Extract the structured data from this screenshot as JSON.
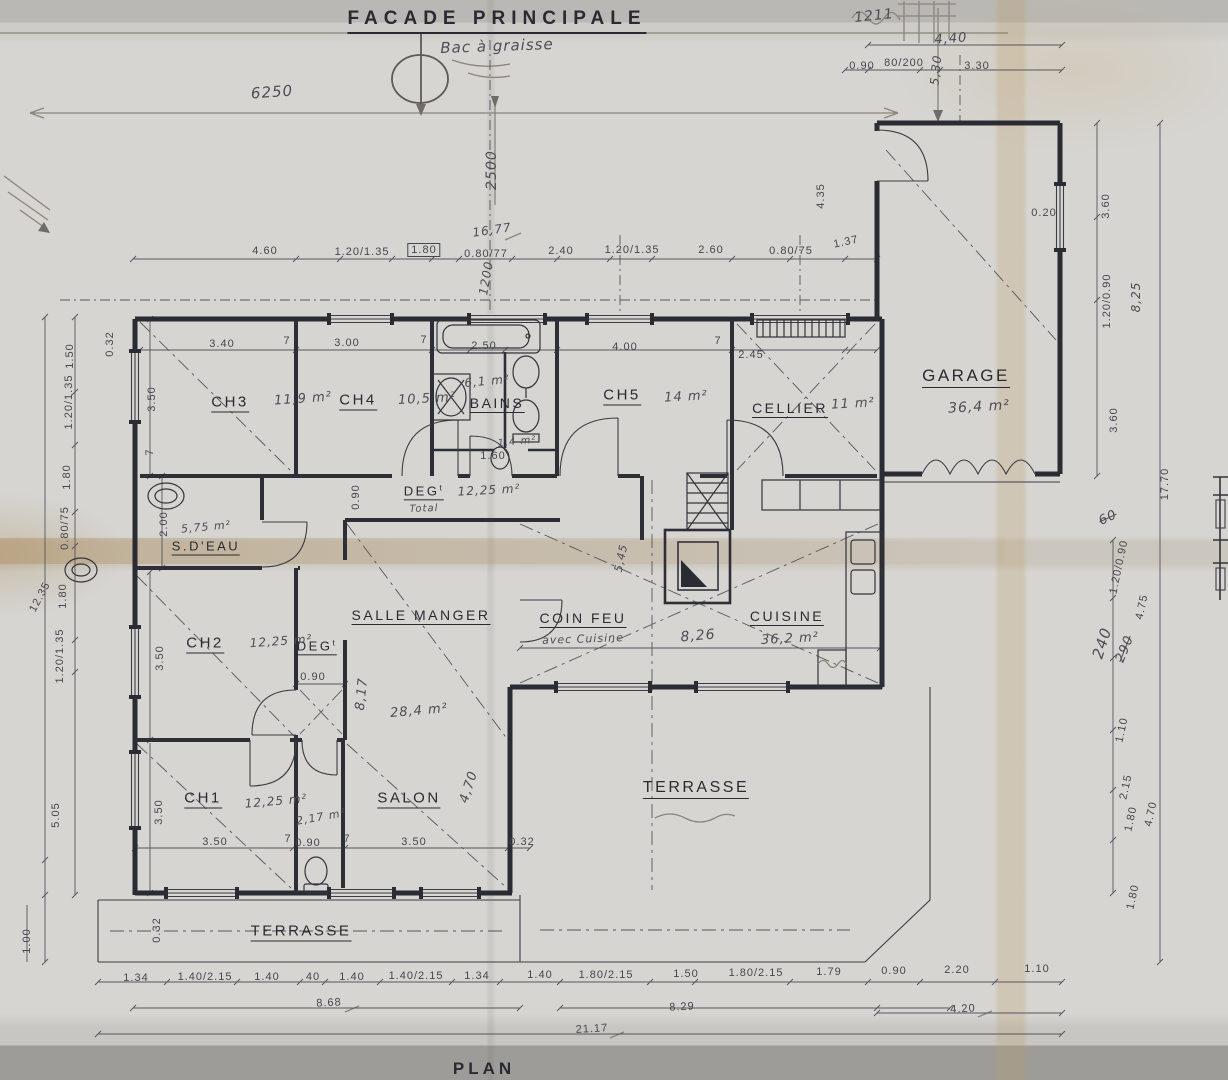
{
  "colors": {
    "ink": "#2a2a32",
    "dim": "#46464e"
  },
  "titles": {
    "main": "FACADE PRINCIPALE",
    "plan": "PLAN"
  },
  "plan": {
    "rooms": [
      {
        "text": "CH3",
        "x": 230,
        "y": 403,
        "u": true
      },
      {
        "text": "CH4",
        "x": 358,
        "y": 401,
        "u": true
      },
      {
        "text": "BAINS",
        "x": 497,
        "y": 404,
        "size": 14,
        "u": true
      },
      {
        "text": "CH5",
        "x": 622,
        "y": 396,
        "u": true
      },
      {
        "text": "CELLIER",
        "x": 790,
        "y": 409,
        "size": 14,
        "u": true
      },
      {
        "text": "GARAGE",
        "x": 966,
        "y": 377,
        "size": 17,
        "u": true
      },
      {
        "text": "S.D'EAU",
        "x": 206,
        "y": 547,
        "size": 13,
        "u": true
      },
      {
        "text": "DEG",
        "sup": "t",
        "x": 424,
        "y": 492,
        "size": 13,
        "u": true
      },
      {
        "text": "SALLE MANGER",
        "x": 421,
        "y": 616,
        "size": 14,
        "u": true
      },
      {
        "text": "COIN FEU",
        "x": 583,
        "y": 619,
        "size": 14,
        "u": true
      },
      {
        "text": "CUISINE",
        "x": 787,
        "y": 617,
        "size": 14,
        "u": true
      },
      {
        "text": "CH2",
        "x": 205,
        "y": 644,
        "u": true
      },
      {
        "text": "DEG",
        "sup": "t",
        "x": 317,
        "y": 647,
        "size": 13,
        "u": true
      },
      {
        "text": "CH1",
        "x": 203,
        "y": 799,
        "u": true
      },
      {
        "text": "SALON",
        "x": 409,
        "y": 799,
        "u": true
      },
      {
        "text": "TERRASSE",
        "x": 301,
        "y": 932,
        "size": 15,
        "u": true
      },
      {
        "text": "TERRASSE",
        "x": 696,
        "y": 789,
        "size": 16,
        "u": true
      }
    ],
    "dimensions": [
      {
        "text": "4.60",
        "x": 265,
        "y": 251
      },
      {
        "text": "1.20/1.35",
        "x": 362,
        "y": 252
      },
      {
        "text": "1.80",
        "x": 424,
        "y": 250,
        "box": true
      },
      {
        "text": "0.80/77",
        "x": 486,
        "y": 254
      },
      {
        "text": "2.40",
        "x": 561,
        "y": 251
      },
      {
        "text": "1.20/1.35",
        "x": 632,
        "y": 250
      },
      {
        "text": "2.60",
        "x": 711,
        "y": 250
      },
      {
        "text": "0.80/75",
        "x": 791,
        "y": 251
      },
      {
        "text": "1.37",
        "x": 846,
        "y": 242,
        "rot": -12
      },
      {
        "text": "0.90",
        "x": 862,
        "y": 66
      },
      {
        "text": "80/200",
        "x": 904,
        "y": 63
      },
      {
        "text": "3.30",
        "x": 977,
        "y": 66
      },
      {
        "text": "0.20",
        "x": 1044,
        "y": 213
      },
      {
        "text": "4.35",
        "x": 821,
        "y": 196,
        "rot": -90
      },
      {
        "text": "0.32",
        "x": 110,
        "y": 344,
        "rot": -90
      },
      {
        "text": "3.40",
        "x": 222,
        "y": 344
      },
      {
        "text": "7",
        "x": 287,
        "y": 341
      },
      {
        "text": "3.00",
        "x": 347,
        "y": 343
      },
      {
        "text": "7",
        "x": 424,
        "y": 340
      },
      {
        "text": "2.50",
        "x": 484,
        "y": 346
      },
      {
        "text": "4.00",
        "x": 625,
        "y": 347
      },
      {
        "text": "7",
        "x": 718,
        "y": 341
      },
      {
        "text": "2.45",
        "x": 751,
        "y": 355
      },
      {
        "text": "1.50",
        "x": 70,
        "y": 356,
        "rot": -90
      },
      {
        "text": "1.20/1.35",
        "x": 69,
        "y": 402,
        "rot": -90
      },
      {
        "text": "1.80",
        "x": 67,
        "y": 477,
        "rot": -90
      },
      {
        "text": "0.80/75",
        "x": 65,
        "y": 528,
        "rot": -90
      },
      {
        "text": "1.80",
        "x": 63,
        "y": 596,
        "rot": -90
      },
      {
        "text": "12.35",
        "x": 40,
        "y": 597,
        "rot": -62
      },
      {
        "text": "1.20/1.35",
        "x": 60,
        "y": 656,
        "rot": -90
      },
      {
        "text": "5.05",
        "x": 56,
        "y": 815,
        "rot": -90
      },
      {
        "text": "1.00",
        "x": 27,
        "y": 941,
        "rot": -90
      },
      {
        "text": "3.50",
        "x": 152,
        "y": 399,
        "rot": -90
      },
      {
        "text": "7",
        "x": 150,
        "y": 452,
        "rot": -90
      },
      {
        "text": "2.00",
        "x": 164,
        "y": 524,
        "rot": -90
      },
      {
        "text": "3.50",
        "x": 160,
        "y": 658,
        "rot": -90
      },
      {
        "text": "3.50",
        "x": 159,
        "y": 812,
        "rot": -90
      },
      {
        "text": "0.32",
        "x": 157,
        "y": 930,
        "rot": -90
      },
      {
        "text": "0.90",
        "x": 356,
        "y": 497,
        "rot": -90
      },
      {
        "text": "1.60",
        "x": 493,
        "y": 456
      },
      {
        "text": "0.90",
        "x": 313,
        "y": 677
      },
      {
        "text": "3.50",
        "x": 215,
        "y": 842
      },
      {
        "text": "7",
        "x": 288,
        "y": 839
      },
      {
        "text": "0.90",
        "x": 308,
        "y": 843
      },
      {
        "text": "7",
        "x": 347,
        "y": 839
      },
      {
        "text": "3.50",
        "x": 414,
        "y": 842
      },
      {
        "text": "0.32",
        "x": 522,
        "y": 842
      },
      {
        "text": "3.60",
        "x": 1106,
        "y": 206,
        "rot": -90
      },
      {
        "text": "1.20/0.90",
        "x": 1107,
        "y": 301,
        "rot": -90
      },
      {
        "text": "3.60",
        "x": 1114,
        "y": 420,
        "rot": -90
      },
      {
        "text": "17.70",
        "x": 1165,
        "y": 484,
        "rot": -90
      },
      {
        "text": "1.20/0.90",
        "x": 1119,
        "y": 567,
        "rot": -78
      },
      {
        "text": "4.75",
        "x": 1142,
        "y": 607,
        "rot": -78
      },
      {
        "text": "1.10",
        "x": 1122,
        "y": 730,
        "rot": -78
      },
      {
        "text": "2.15",
        "x": 1126,
        "y": 787,
        "rot": -78
      },
      {
        "text": "1.80",
        "x": 1131,
        "y": 819,
        "rot": -78
      },
      {
        "text": "4.70",
        "x": 1151,
        "y": 814,
        "rot": -78
      },
      {
        "text": "1.80",
        "x": 1133,
        "y": 897,
        "rot": -78
      },
      {
        "text": "1.34",
        "x": 136,
        "y": 978
      },
      {
        "text": "1.40/2.15",
        "x": 205,
        "y": 977
      },
      {
        "text": "1.40",
        "x": 267,
        "y": 977
      },
      {
        "text": "40",
        "x": 313,
        "y": 977
      },
      {
        "text": "1.40",
        "x": 352,
        "y": 977
      },
      {
        "text": "1.40/2.15",
        "x": 416,
        "y": 976
      },
      {
        "text": "1.34",
        "x": 477,
        "y": 976
      },
      {
        "text": "1.40",
        "x": 540,
        "y": 975
      },
      {
        "text": "1.80/2.15",
        "x": 606,
        "y": 975
      },
      {
        "text": "1.50",
        "x": 686,
        "y": 974
      },
      {
        "text": "1.80/2.15",
        "x": 756,
        "y": 973
      },
      {
        "text": "1.79",
        "x": 829,
        "y": 972
      },
      {
        "text": "0.90",
        "x": 894,
        "y": 971
      },
      {
        "text": "2.20",
        "x": 957,
        "y": 970
      },
      {
        "text": "1.10",
        "x": 1037,
        "y": 969
      },
      {
        "text": "8.68",
        "x": 329,
        "y": 1003,
        "rot": -3
      },
      {
        "text": "8.29",
        "x": 682,
        "y": 1007,
        "rot": -3
      },
      {
        "text": "4.20",
        "x": 963,
        "y": 1009,
        "rot": -3
      },
      {
        "text": "21.17",
        "x": 592,
        "y": 1029,
        "rot": -3
      }
    ],
    "notes": [
      {
        "text": "Bac à graisse",
        "x": 497,
        "y": 46,
        "rot": -2,
        "size": 15
      },
      {
        "text": "6250",
        "x": 272,
        "y": 92,
        "rot": -4,
        "size": 15
      },
      {
        "text": "2500",
        "x": 492,
        "y": 170,
        "rot": -90,
        "size": 14
      },
      {
        "text": "16,77",
        "x": 492,
        "y": 230,
        "rot": -8,
        "size": 12
      },
      {
        "text": "1200",
        "x": 486,
        "y": 278,
        "rot": -80,
        "size": 12
      },
      {
        "text": "1211",
        "x": 874,
        "y": 16,
        "rot": -6,
        "size": 14
      },
      {
        "text": "4,40",
        "x": 951,
        "y": 39,
        "rot": -4,
        "size": 13
      },
      {
        "text": "5,30",
        "x": 936,
        "y": 70,
        "rot": -84,
        "size": 12
      },
      {
        "text": "11,9 m²",
        "x": 303,
        "y": 399,
        "rot": -4,
        "size": 13
      },
      {
        "text": "10,5 m²",
        "x": 427,
        "y": 399,
        "rot": -3,
        "size": 13
      },
      {
        "text": "6,1 m²",
        "x": 487,
        "y": 381,
        "rot": -5,
        "size": 12
      },
      {
        "text": "14 m²",
        "x": 686,
        "y": 397,
        "rot": -3,
        "size": 13
      },
      {
        "text": "11 m²",
        "x": 853,
        "y": 404,
        "rot": -3,
        "size": 13
      },
      {
        "text": "36,4 m²",
        "x": 979,
        "y": 407,
        "rot": -3,
        "size": 14
      },
      {
        "text": "5,75 m²",
        "x": 206,
        "y": 527,
        "rot": -5,
        "size": 11
      },
      {
        "text": "12,25 m²",
        "x": 489,
        "y": 490,
        "rot": -3,
        "size": 12
      },
      {
        "text": "Total",
        "x": 424,
        "y": 509,
        "rot": -2,
        "size": 10
      },
      {
        "text": "12,25 m²",
        "x": 281,
        "y": 641,
        "rot": -4,
        "size": 12
      },
      {
        "text": "28,4 m²",
        "x": 419,
        "y": 711,
        "rot": -5,
        "size": 13
      },
      {
        "text": "avec Cuisine",
        "x": 583,
        "y": 639,
        "rot": -2,
        "size": 11
      },
      {
        "text": "36,2 m²",
        "x": 790,
        "y": 639,
        "rot": -3,
        "size": 13
      },
      {
        "text": "8,26",
        "x": 698,
        "y": 636,
        "rot": -5,
        "size": 14
      },
      {
        "text": "8,17",
        "x": 362,
        "y": 694,
        "rot": -84,
        "size": 13
      },
      {
        "text": "12,25 m²",
        "x": 276,
        "y": 801,
        "rot": -5,
        "size": 12
      },
      {
        "text": "2,17 m²",
        "x": 321,
        "y": 817,
        "rot": -10,
        "size": 11
      },
      {
        "text": "4,70",
        "x": 469,
        "y": 787,
        "rot": -72,
        "size": 13
      },
      {
        "text": "1,4 m²",
        "x": 517,
        "y": 442,
        "rot": -6,
        "size": 10
      },
      {
        "text": "5,45",
        "x": 621,
        "y": 558,
        "rot": -78,
        "size": 11
      },
      {
        "text": "8,25",
        "x": 1136,
        "y": 297,
        "rot": -90,
        "size": 12
      },
      {
        "text": "240",
        "x": 1102,
        "y": 643,
        "rot": -72,
        "size": 15
      },
      {
        "text": "290",
        "x": 1125,
        "y": 649,
        "rot": -68,
        "size": 13,
        "strike": true
      },
      {
        "text": "60",
        "x": 1108,
        "y": 518,
        "rot": -25,
        "size": 13,
        "strike": true
      }
    ]
  }
}
